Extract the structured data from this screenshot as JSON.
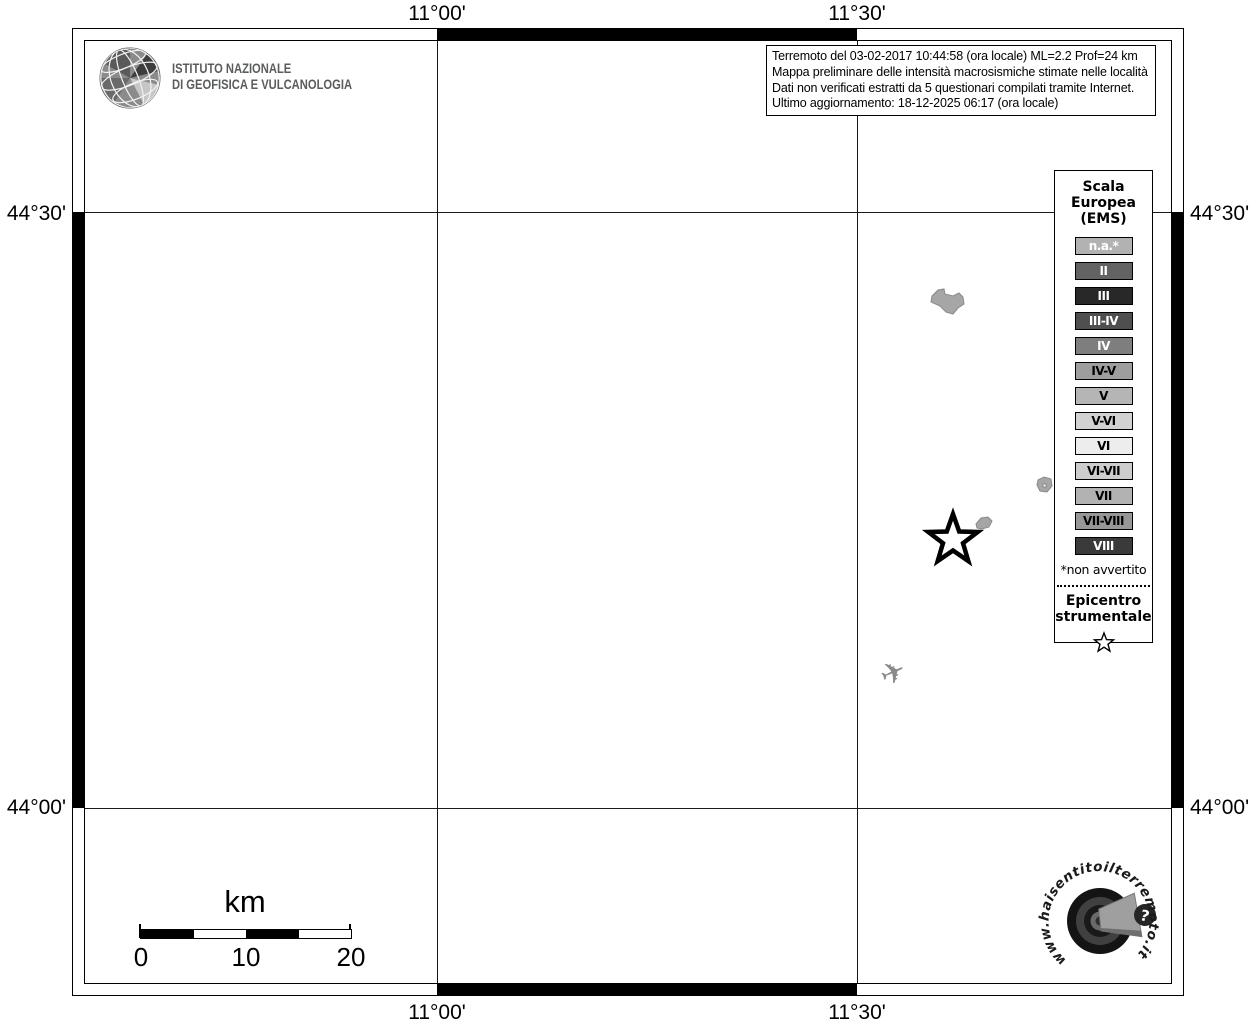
{
  "header": {
    "ingv_name_line1": "ISTITUTO NAZIONALE",
    "ingv_name_line2": "DI GEOFISICA E VULCANOLOGIA"
  },
  "info_box": {
    "line1": "Terremoto del 03-02-2017 10:44:58 (ora locale) ML=2.2 Prof=24 km",
    "line2": "Mappa preliminare delle intensità macrosismiche stimate nelle località",
    "line3": "Dati non verificati estratti da 5 questionari compilati tramite Internet.",
    "line4": "Ultimo aggiornamento: 18-12-2025 06:17 (ora locale)"
  },
  "map": {
    "coordinates": {
      "top": [
        "11°00'",
        "11°30'"
      ],
      "bottom": [
        "11°00'",
        "11°30'"
      ],
      "left": [
        "44°30'",
        "44°00'"
      ],
      "right": [
        "44°30'",
        "44°00'"
      ]
    },
    "features": {
      "epicenter_symbol": "star",
      "urban_area_polygons": 3,
      "airport_symbol": "airplane"
    }
  },
  "legend": {
    "title_line1": "Scala",
    "title_line2": "Europea",
    "title_line3": "(EMS)",
    "items": [
      {
        "label": "n.a.*",
        "bg": "#b2b2b2",
        "fg": "#ffffff"
      },
      {
        "label": "II",
        "bg": "#636363",
        "fg": "#ffffff"
      },
      {
        "label": "III",
        "bg": "#282828",
        "fg": "#ffffff"
      },
      {
        "label": "III-IV",
        "bg": "#4f4f4f",
        "fg": "#ffffff"
      },
      {
        "label": "IV",
        "bg": "#7e7e7e",
        "fg": "#ffffff"
      },
      {
        "label": "IV-V",
        "bg": "#9e9e9e",
        "fg": "#000000"
      },
      {
        "label": "V",
        "bg": "#b5b5b5",
        "fg": "#000000"
      },
      {
        "label": "V-VI",
        "bg": "#d2d2d2",
        "fg": "#000000"
      },
      {
        "label": "VI",
        "bg": "#ededed",
        "fg": "#000000"
      },
      {
        "label": "VI-VII",
        "bg": "#cdcdcd",
        "fg": "#000000"
      },
      {
        "label": "VII",
        "bg": "#b2b2b2",
        "fg": "#000000"
      },
      {
        "label": "VII-VIII",
        "bg": "#979797",
        "fg": "#000000"
      },
      {
        "label": "VIII",
        "bg": "#3a3a3a",
        "fg": "#ffffff"
      }
    ],
    "footnote": "*non avvertito",
    "epicenter_line1": "Epicentro",
    "epicenter_line2": "strumentale"
  },
  "scale_bar": {
    "unit": "km",
    "ticks": [
      "0",
      "10",
      "20"
    ]
  },
  "watermark": {
    "url_text": "www.haisentitoilterremoto.it",
    "question_mark": "?"
  }
}
